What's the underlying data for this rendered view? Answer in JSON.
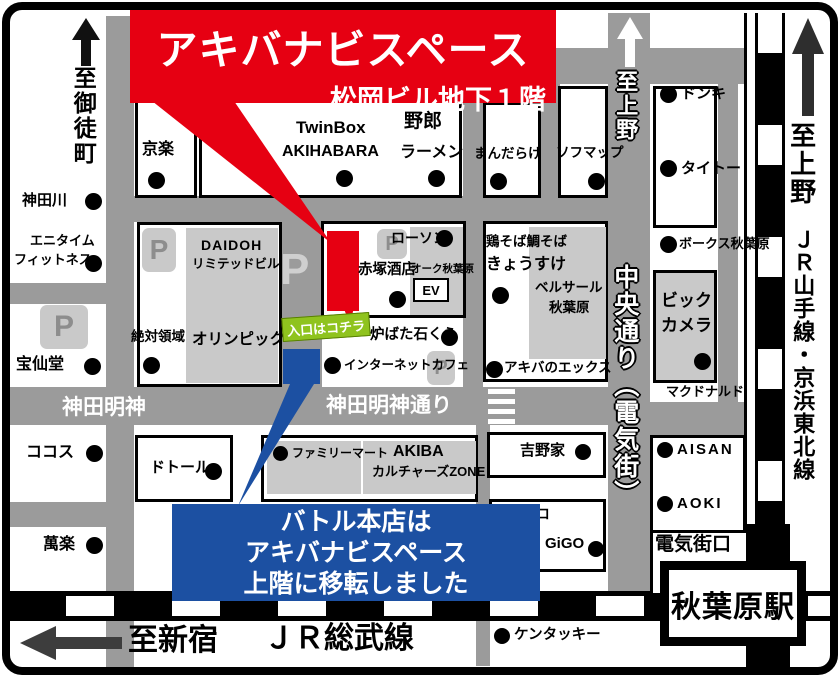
{
  "banner": {
    "title": "アキバナビスペース",
    "subtitle": "松岡ビル地下１階"
  },
  "callout": {
    "line1": "バトル本店は",
    "line2": "アキバナビスペース",
    "line3": "上階に移転しました"
  },
  "entrance": {
    "label": "入口はコチラ"
  },
  "directions": {
    "okachimachi": "至御徒町",
    "ueno_road": "至上野",
    "ueno_rail": "至上野",
    "yamanote_line": "ＪＲ山手線・京浜東北線",
    "shinjuku": "至新宿"
  },
  "streets": {
    "kanda_myojin": "神田明神",
    "kanda_myojin_dori": "神田明神通り",
    "chuo_dori": "中央通り（電気街）",
    "sobu_line": "ＪＲ総武線"
  },
  "station": {
    "name": "秋葉原駅",
    "gate": "電気街口"
  },
  "parking": {
    "symbol": "P"
  },
  "buildings": {
    "daidoh_l1": "DAIDOH",
    "daidoh_l2": "リミテッドビル",
    "olympic": "オリンピック",
    "twinbox_l1": "TwinBox",
    "twinbox_l2": "AKIHABARA",
    "yarou_l1": "野郎",
    "yarou_l2": "ラーメン",
    "akatsuka": "赤塚酒店",
    "oak": "オーク秋葉原",
    "ev": "EV",
    "kyosuke_l1": "鶏そば鯛そば",
    "kyosuke_l2": "きょうすけ",
    "bellesalle_l1": "ベルサール",
    "bellesalle_l2": "秋葉原",
    "bic_l1": "ビック",
    "bic_l2": "カメラ",
    "zone_l1": "AKIBA",
    "zone_l2": "カルチャーズZONE"
  },
  "pois": {
    "kyoraku": "京楽",
    "kandagawa": "神田川",
    "anytime_l1": "エニタイム",
    "anytime_l2": "フィットネス",
    "hosendo": "宝仙堂",
    "zettai": "絶対領域",
    "cocos": "ココス",
    "manraku": "萬楽",
    "dotour": "ドトール",
    "famima": "ファミリーマート",
    "mandarake": "まんだらけ",
    "sofmap": "ソフマップ",
    "donki": "ドンキ",
    "taito": "タイトー",
    "volks": "ボークス秋葉原",
    "mcdonalds": "マクドナルド",
    "lawson": "ローソン",
    "robata": "炉ばた石くら",
    "netcafe": "インターネットカフェ",
    "yoshinoya": "吉野家",
    "pachinko": "パチンコ",
    "gigo": "GiGO",
    "aisan": "AISAN",
    "aoki": "AOKI",
    "kentucky": "ケンタッキー",
    "akiba_x": "アキバのエックス"
  },
  "colors": {
    "accent_red": "#e60012",
    "accent_blue": "#1c50a2",
    "entrance_green": "#8fc31e",
    "road_gray": "#9b9b9b",
    "building_gray": "#c9c9c9"
  }
}
